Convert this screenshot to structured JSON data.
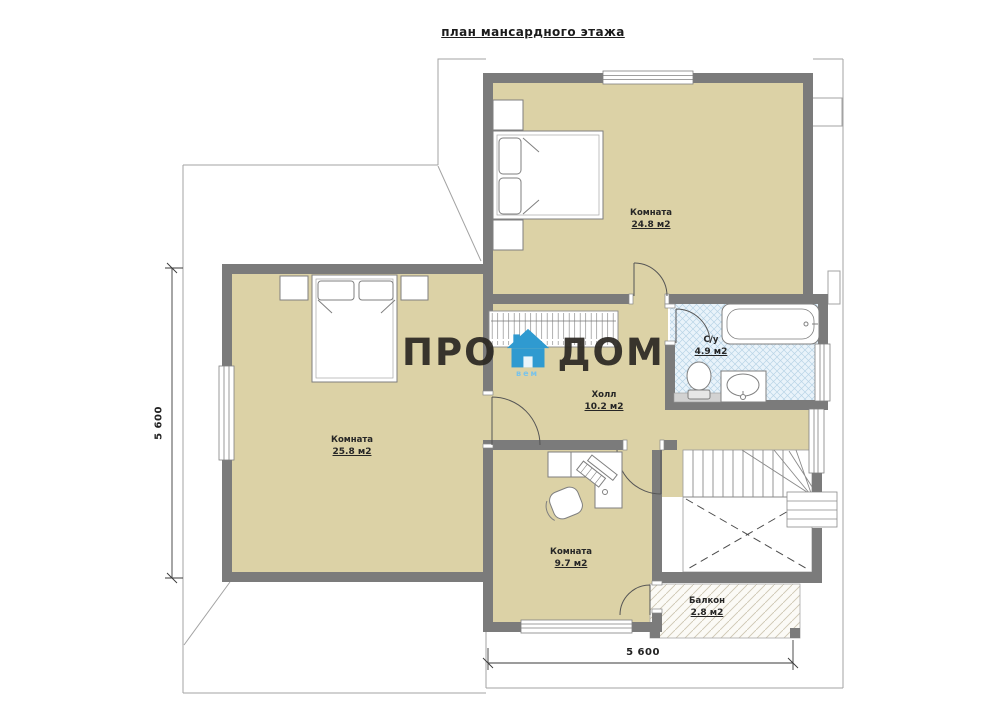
{
  "title": "план мансардного этажа",
  "rooms": [
    {
      "name": "Комната",
      "area": "24.8 м2"
    },
    {
      "name": "Комната",
      "area": "25.8 м2"
    },
    {
      "name": "Холл",
      "area": "10.2 м2"
    },
    {
      "name": "С/у",
      "area": "4.9 м2"
    },
    {
      "name": "Комната",
      "area": "9.7 м2"
    },
    {
      "name": "Балкон",
      "area": "2.8 м2"
    }
  ],
  "dimensions": {
    "left": "5 600",
    "bottom": "5 600"
  },
  "watermark": {
    "pro": "ПРО",
    "dom": "ДОМ",
    "sub": "вем",
    "house_color": "#2f9ad0"
  },
  "colors": {
    "wall": "#7b7b7b",
    "floor": "#dcd2a6",
    "bath_floor": "#e9f3fa",
    "bath_hatch": "#b9d4e6",
    "balcony_hatch": "#cdc6b2",
    "roofline": "#a3a3a3",
    "label_text": "#262626",
    "accent_blue": "#2f9ad0"
  }
}
